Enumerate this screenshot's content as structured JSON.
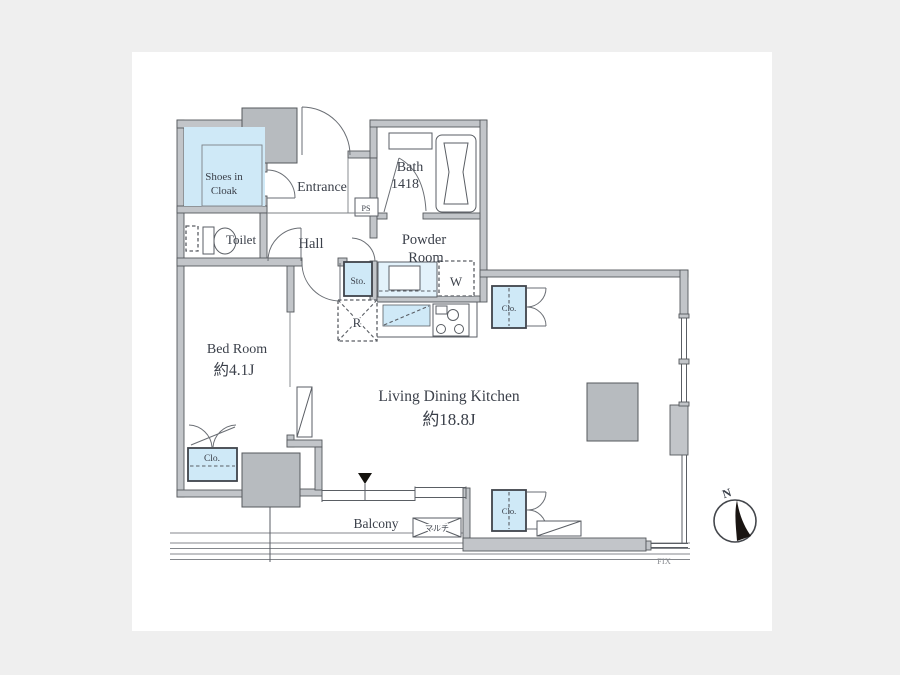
{
  "page": {
    "background_color": "#efefef",
    "canvas_color": "#ffffff"
  },
  "colors": {
    "wall_gray": "#c2c5c9",
    "pillar_gray": "#b7bbbf",
    "accent_blue": "#cfe9f7",
    "outline_dark": "#55585c",
    "text_color": "#3b404a",
    "muted_text": "#8a8d92"
  },
  "rooms": {
    "shoes_in_cloak": {
      "line1": "Shoes in",
      "line2": "Cloak"
    },
    "entrance": {
      "label": "Entrance"
    },
    "bath": {
      "line1": "Bath",
      "line2": "1418"
    },
    "toilet": {
      "label": "Toilet"
    },
    "hall": {
      "label": "Hall"
    },
    "powder_room": {
      "line1": "Powder",
      "line2": "Room"
    },
    "bed_room": {
      "name": "Bed Room",
      "size": "約4.1J"
    },
    "living_dining_kitchen": {
      "name": "Living Dining Kitchen",
      "size": "約18.8J"
    },
    "balcony": {
      "label": "Balcony"
    }
  },
  "fixtures": {
    "pipe_space": "PS",
    "storage": "Sto.",
    "washer": "W",
    "refrigerator": "R",
    "closet_kitchen": "Clo.",
    "closet_living": "Clo.",
    "closet_bedroom": "Clo.",
    "multi_outlet": "マルチ",
    "fix_window": "FIX"
  },
  "compass": {
    "north": "N"
  }
}
